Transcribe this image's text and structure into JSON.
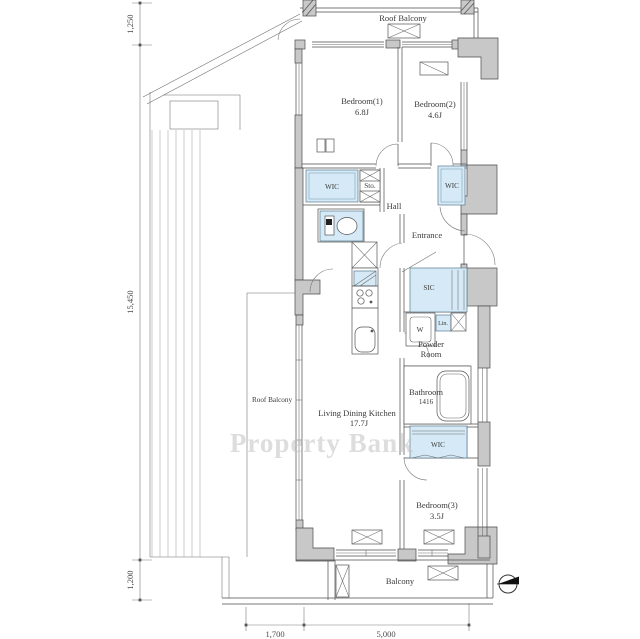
{
  "rooms": {
    "roof_balcony_top": "Roof Balcony",
    "bedroom1": "Bedroom(1)",
    "bedroom1_size": "6.8J",
    "bedroom2": "Bedroom(2)",
    "bedroom2_size": "4.6J",
    "wic_left": "WIC",
    "storage": "Sto.",
    "hall": "Hall",
    "wic_right": "WIC",
    "entrance": "Entrance",
    "sic": "SIC",
    "washer": "W",
    "linen": "Lin.",
    "powder_line1": "Powder",
    "powder_line2": "Room",
    "bathroom": "Bathroom",
    "bathroom_size": "1416",
    "roof_balcony_left": "Roof Balcony",
    "ldk": "Living Dining Kitchen",
    "ldk_size": "17.7J",
    "wic_bottom": "WIC",
    "bedroom3": "Bedroom(3)",
    "bedroom3_size": "3.5J",
    "balcony": "Balcony"
  },
  "dimensions": {
    "left": [
      "1,250",
      "15,450",
      "1,200"
    ],
    "bottom": [
      "1,700",
      "5,000"
    ]
  },
  "watermark": "Property Bank",
  "colors": {
    "wall_fill": "#c8c8c8",
    "closet_fill": "#d5eaf6",
    "line": "#4d4d4d",
    "background": "#ffffff"
  }
}
